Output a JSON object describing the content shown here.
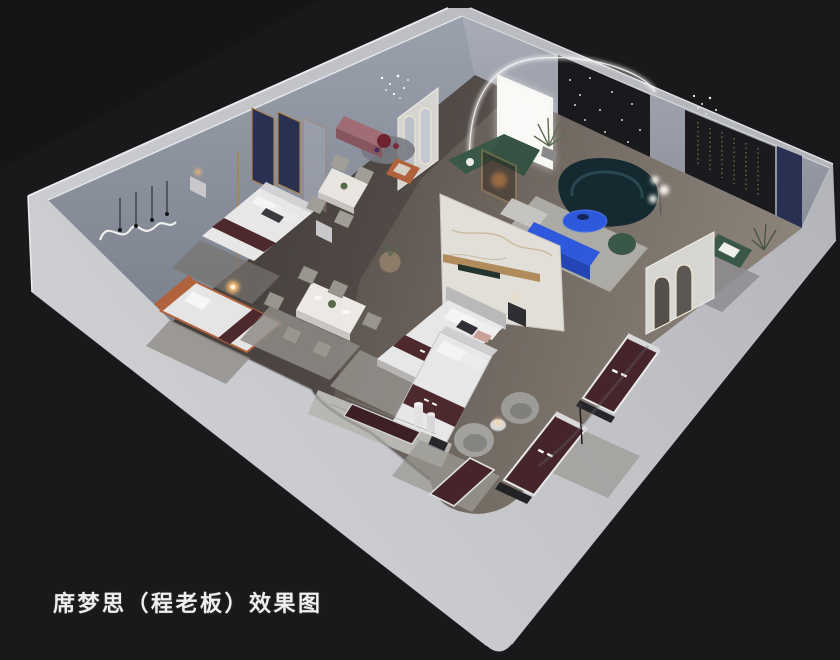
{
  "caption": {
    "text": "席梦思（程老板）效果图"
  },
  "scene": {
    "type": "3d-interior-rendering",
    "subject": "mattress showroom cutaway axonometric render",
    "colors": {
      "background": "#19191b",
      "slab_bright": "#d6d7da",
      "slab_mid": "#c3c4c8",
      "slab_dim": "#aeb0b5",
      "wall_inner_left": "#8e94a1",
      "wall_inner_right": "#a0a5af",
      "floor_dark": "#453f3b",
      "floor_mid": "#6e655e",
      "floor_light": "#8f867c",
      "accent_blue": "#2e59dd",
      "sofa_teal": "#142a30",
      "sofa_green": "#3a5847",
      "mattress_maroon": "#45242a",
      "runner_maroon": "#4d282c",
      "navy_panel": "#2a3052",
      "marble": "#e2dfd8",
      "mauve": "#a06d74",
      "orange": "#b0623c",
      "gold_trim": "#ab834f",
      "led_white": "#f5f5f2",
      "lamp_warm": "#ffbf72",
      "bed_white": "#e8e7e7",
      "rug_gray": "#9b9893"
    },
    "objects": [
      "exterior-slab-and-walls",
      "back-left-wall",
      "back-right-wall",
      "wood-floor",
      "arched-led-portal",
      "backlit-panel",
      "dark-art-panel",
      "feature-string-light-panel",
      "navy-accent-wall",
      "marble-partition",
      "capsule-mirror-partition",
      "arch-mirror-wall",
      "navy-headboard-panels",
      "wavy-led-wall-art",
      "crystal-chandelier",
      "bed",
      "single-bed-orange",
      "queen-bed",
      "display-bed",
      "display-mattress",
      "dining-table-six-chairs",
      "dining-table-four-chairs",
      "round-side-table",
      "curved-teal-sofa",
      "blue-oval-coffee-table",
      "blue-media-console",
      "knit-pouf",
      "green-sectional-sofa",
      "wood-display-stand",
      "green-armchair",
      "swivel-tub-chairs",
      "mauve-sideboard",
      "orange-lounge-chair",
      "round-rug",
      "area-rug",
      "floor-lamp",
      "bedside-lamp",
      "potted-plant",
      "nightstand",
      "marble-walkway"
    ]
  }
}
